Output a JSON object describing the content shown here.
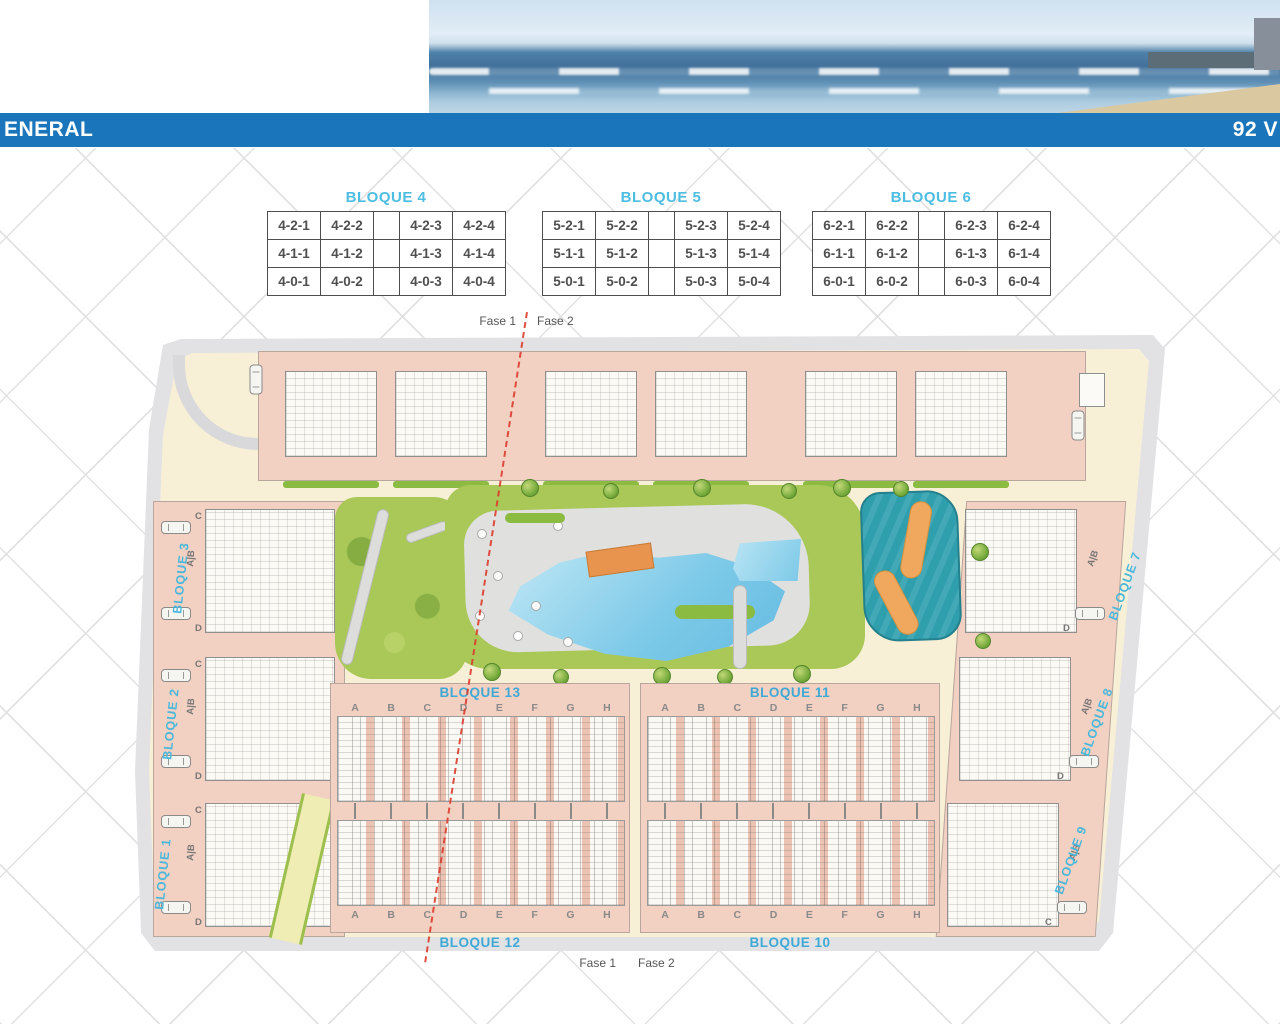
{
  "header": {
    "left_title": "ENERAL",
    "right_title": "92 V"
  },
  "unit_tables": [
    {
      "title": "BLOQUE 4",
      "rows": [
        [
          "4-2-1",
          "4-2-2",
          "",
          "4-2-3",
          "4-2-4"
        ],
        [
          "4-1-1",
          "4-1-2",
          "",
          "4-1-3",
          "4-1-4"
        ],
        [
          "4-0-1",
          "4-0-2",
          "",
          "4-0-3",
          "4-0-4"
        ]
      ]
    },
    {
      "title": "BLOQUE 5",
      "rows": [
        [
          "5-2-1",
          "5-2-2",
          "",
          "5-2-3",
          "5-2-4"
        ],
        [
          "5-1-1",
          "5-1-2",
          "",
          "5-1-3",
          "5-1-4"
        ],
        [
          "5-0-1",
          "5-0-2",
          "",
          "5-0-3",
          "5-0-4"
        ]
      ]
    },
    {
      "title": "BLOQUE 6",
      "rows": [
        [
          "6-2-1",
          "6-2-2",
          "",
          "6-2-3",
          "6-2-4"
        ],
        [
          "6-1-1",
          "6-1-2",
          "",
          "6-1-3",
          "6-1-4"
        ],
        [
          "6-0-1",
          "6-0-2",
          "",
          "6-0-3",
          "6-0-4"
        ]
      ]
    }
  ],
  "phase_markers": {
    "top": {
      "left": "Fase 1",
      "right": "Fase 2"
    },
    "bottom": {
      "left": "Fase 1",
      "right": "Fase 2"
    }
  },
  "site_plan": {
    "left_blocks": [
      "BLOQUE 3",
      "BLOQUE 2",
      "BLOQUE 1"
    ],
    "right_blocks": [
      "BLOQUE 7",
      "BLOQUE 8",
      "BLOQUE 9"
    ],
    "row_labels": {
      "top_left": "BLOQUE 13",
      "top_right": "BLOQUE 11",
      "bottom_left": "BLOQUE 12",
      "bottom_right": "BLOQUE 10"
    },
    "unit_letters": [
      "A",
      "B",
      "C",
      "D",
      "E",
      "F",
      "G",
      "H"
    ],
    "apartment_letters": {
      "ab": "A|B",
      "c": "C",
      "d": "D"
    }
  },
  "colors": {
    "header_bar": "#1b75bb",
    "bloque_label": "#49b8dc",
    "building_fill": "#f2d0c2",
    "ground": "#f8f0d6",
    "pool": "#7cc9e8",
    "splash_pool": "#2f9fae",
    "splash_path": "#f0a85e",
    "road": "#e2e2e4",
    "green": "#a9c858",
    "phase_line": "#dc3c2e"
  }
}
